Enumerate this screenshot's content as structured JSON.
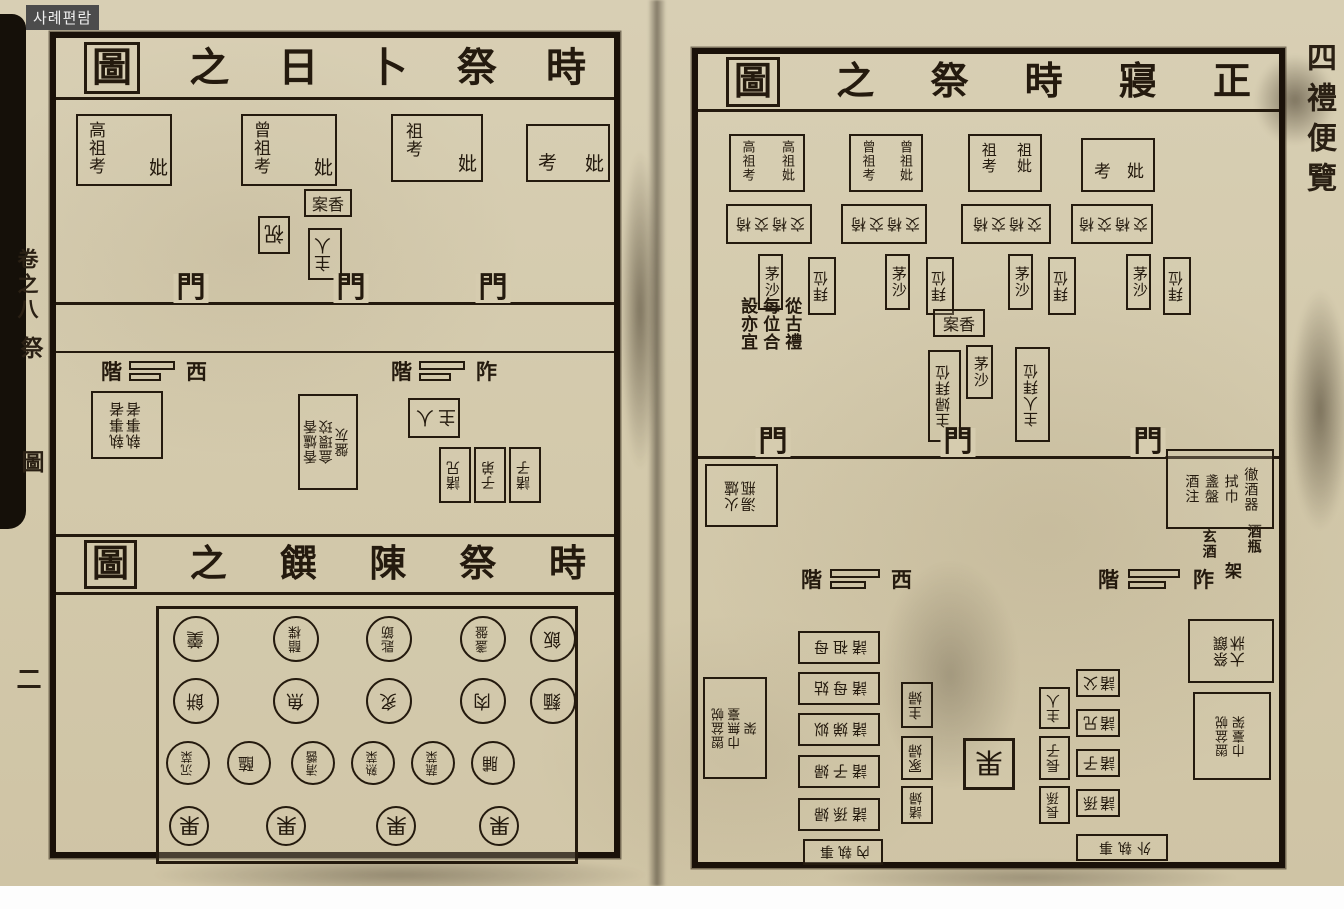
{
  "badge": {
    "label": "사례편람"
  },
  "left_page": {
    "margin": {
      "volume": "卷之八",
      "section": "祭",
      "figure": "圖",
      "page_number": "二"
    },
    "divination": {
      "title": "時祭卜日之圖",
      "shrines": [
        {
          "main": "高祖考",
          "consort": "妣"
        },
        {
          "main": "曾祖考",
          "consort": "妣"
        },
        {
          "main": "祖考",
          "consort": "妣"
        },
        {
          "main": "考",
          "consort": "妣"
        }
      ],
      "incense_table": "香案",
      "liturgist": "祝",
      "host_upper": "主人",
      "gates": [
        "門",
        "門",
        "門"
      ],
      "west_steps": {
        "stair": "階",
        "label": "西"
      },
      "east_steps": {
        "stair": "階",
        "label": "阼"
      },
      "attendants": "執事者執事者",
      "utensils": "香爐香盒環珓盤灰",
      "host_lower": "主人",
      "kinsmen": [
        "諸兄",
        "子弟",
        "諸子"
      ]
    },
    "food_layout": {
      "title": "時祭陳饌之圖",
      "row1": [
        "羹",
        "醋楪",
        "匙筯",
        "盞盤",
        "飯"
      ],
      "row2": [
        "餅",
        "魚",
        "炙",
        "肉",
        "麵"
      ],
      "row3": [
        "沉菜",
        "醢",
        "清醬",
        "熟菜",
        "蔬菜",
        "脯"
      ],
      "row4": [
        "果",
        "果",
        "果",
        "果"
      ]
    }
  },
  "right_page": {
    "margin": {
      "spine_title": "四禮便覽"
    },
    "hall": {
      "title": "正寢時祭之圖",
      "note": "從古禮每位合設亦宜",
      "shrines": [
        {
          "male": "高祖考",
          "female": "高祖妣"
        },
        {
          "male": "曾祖考",
          "female": "曾祖妣"
        },
        {
          "male": "祖考",
          "female": "祖妣"
        },
        {
          "male": "考",
          "female": "妣"
        }
      ],
      "chairs": [
        "交椅交椅",
        "交椅交椅",
        "交椅交椅",
        "交椅交椅"
      ],
      "stations": [
        {
          "mosa": "茅沙",
          "bow": "拜位"
        },
        {
          "mosa": "茅沙",
          "bow": "拜位"
        },
        {
          "mosa": "茅沙",
          "bow": "拜位"
        },
        {
          "mosa": "茅沙",
          "bow": "拜位"
        }
      ],
      "incense_table": "香案",
      "center_mosa": "茅沙",
      "hostess_bow": "主婦拜位",
      "host_bow": "主人拜位",
      "gates": [
        "門",
        "門",
        "門"
      ],
      "west_table": "火爐湯瓶",
      "east_table_items": [
        "徹酒器",
        "拭巾",
        "盞盤",
        "酒注"
      ],
      "wine": {
        "dark_wine": "玄酒",
        "bottle": "酒瓶",
        "rack": "架"
      },
      "west_steps": {
        "stair": "階",
        "label": "西"
      },
      "east_steps": {
        "stair": "階",
        "label": "阼"
      }
    },
    "courtyard": {
      "west_basin": "盥盆帨巾無臺架",
      "women_outer": [
        "諸祖母",
        "諸母姑",
        "諸娣姒",
        "諸子婦",
        "諸孫婦"
      ],
      "women_attendants": "內執事",
      "women_inner": [
        "主婦",
        "冢婦",
        "諸婦"
      ],
      "fruit_stand": "果",
      "men_inner": [
        "主人",
        "長子",
        "長孫"
      ],
      "men_outer": [
        "諸父",
        "諸兄",
        "諸子",
        "諸孫"
      ],
      "men_attendants": "外執事",
      "east_food_table": "祭饌大牀",
      "east_basin": "盥盆帨巾臺架"
    }
  }
}
